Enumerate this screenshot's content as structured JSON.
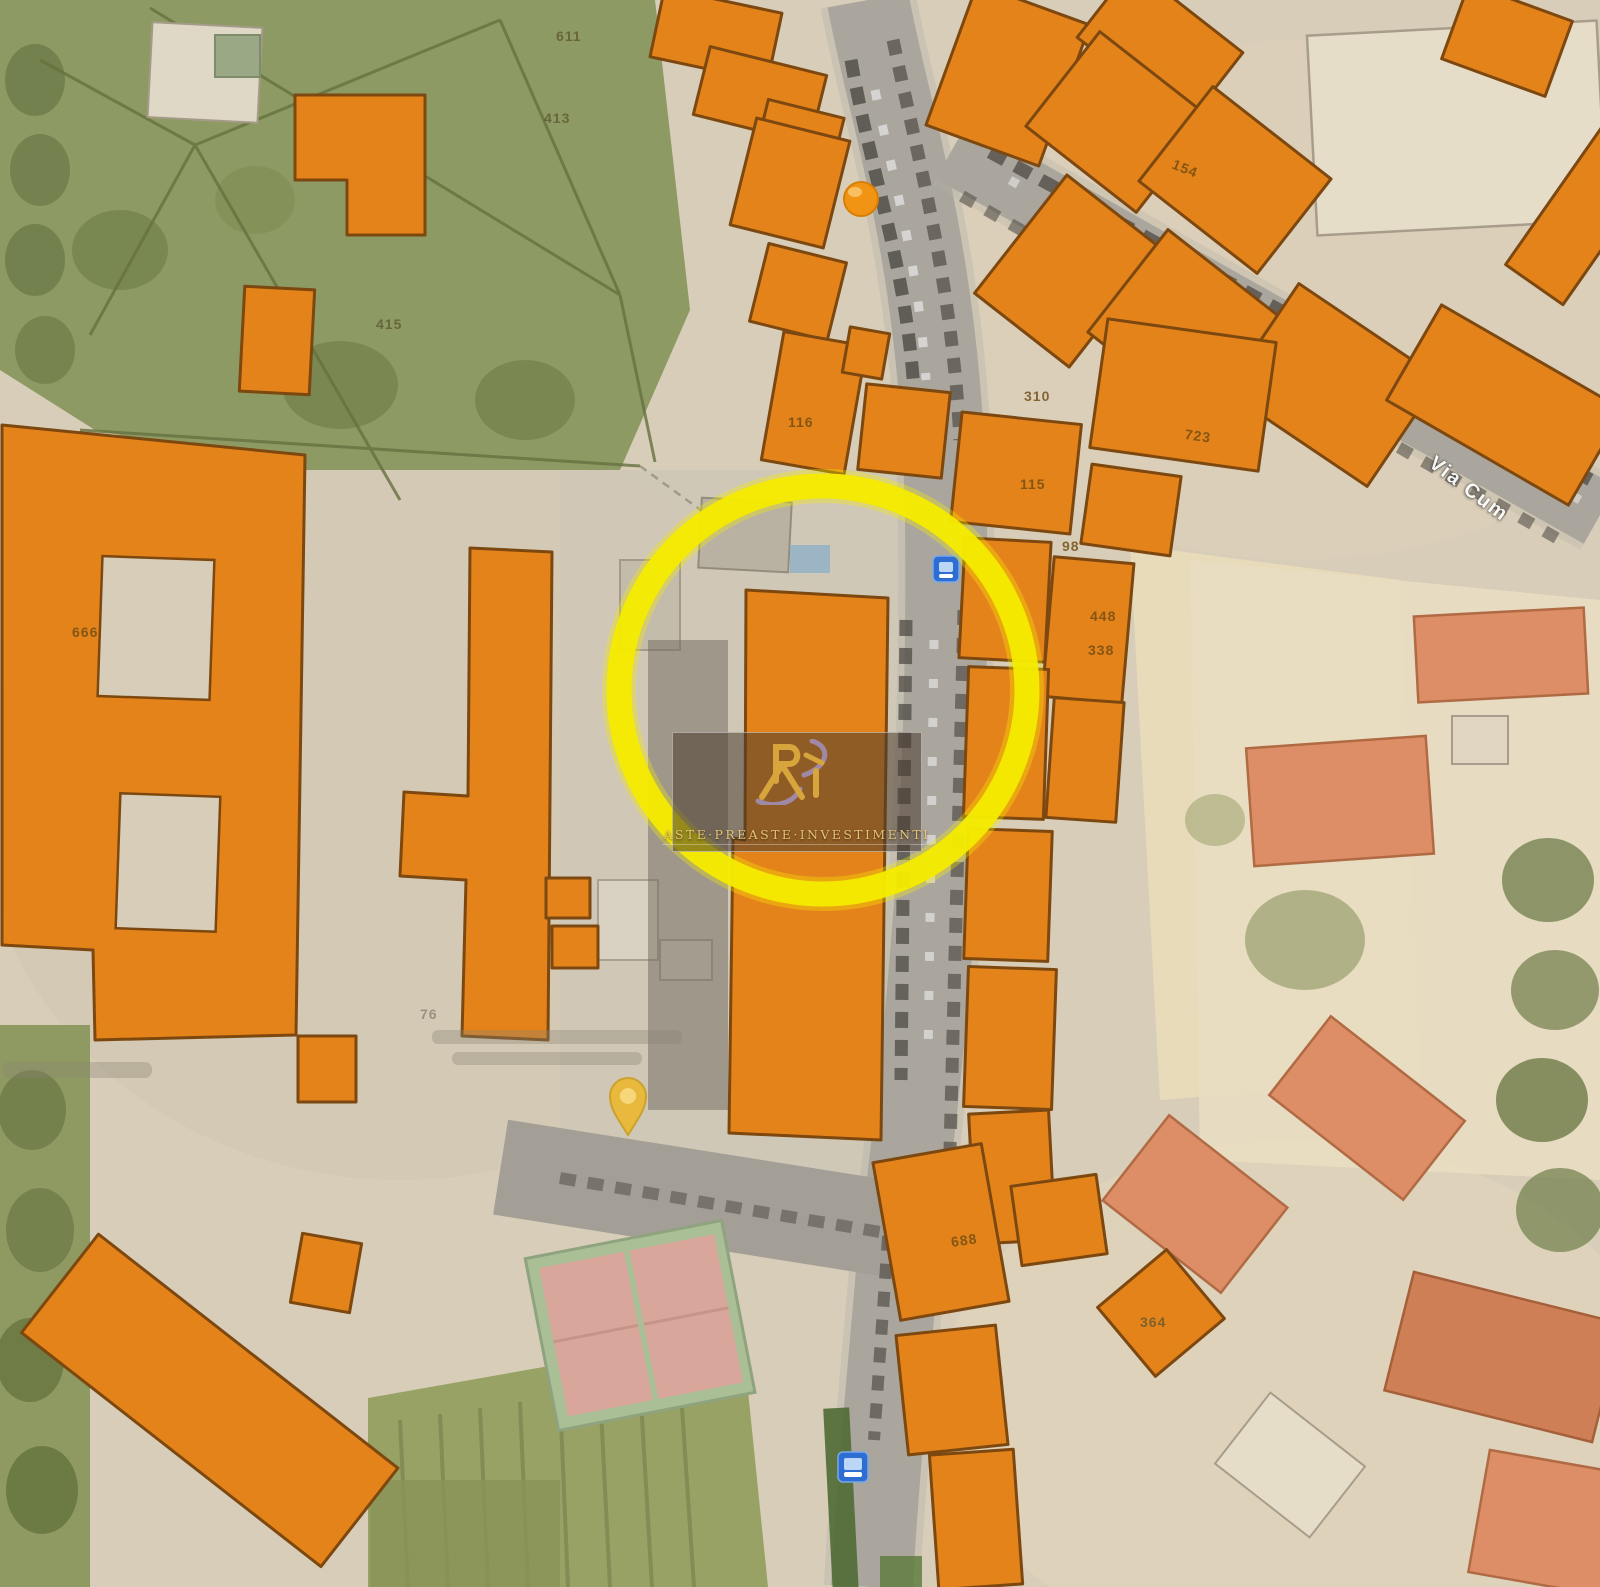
{
  "map": {
    "watermark": {
      "monogram": "Ri",
      "caption": "ASTE·PREASTE·INVESTIMENTI"
    },
    "street_labels": [
      {
        "text": "Via Cum",
        "x": 1438,
        "y": 452,
        "rot": 37
      }
    ],
    "parcel_labels": [
      {
        "text": "611",
        "x": 556,
        "y": 28,
        "rot": 0,
        "v": "green"
      },
      {
        "text": "413",
        "x": 544,
        "y": 110,
        "rot": 0,
        "v": "green"
      },
      {
        "text": "415",
        "x": 376,
        "y": 316,
        "rot": 0,
        "v": "green"
      },
      {
        "text": "666",
        "x": 72,
        "y": 624,
        "rot": 0,
        "v": "orange"
      },
      {
        "text": "116",
        "x": 788,
        "y": 414,
        "rot": 0,
        "v": "orange"
      },
      {
        "text": "154",
        "x": 1176,
        "y": 156,
        "rot": 22,
        "v": "orange"
      },
      {
        "text": "723",
        "x": 1186,
        "y": 426,
        "rot": 8,
        "v": "orange"
      },
      {
        "text": "310",
        "x": 1024,
        "y": 388,
        "rot": 0,
        "v": "orange"
      },
      {
        "text": "115",
        "x": 1020,
        "y": 476,
        "rot": 0,
        "v": "orange"
      },
      {
        "text": "98",
        "x": 1062,
        "y": 538,
        "rot": 0,
        "v": "orange"
      },
      {
        "text": "448",
        "x": 1090,
        "y": 608,
        "rot": 0,
        "v": "orange"
      },
      {
        "text": "338",
        "x": 1088,
        "y": 642,
        "rot": 0,
        "v": "orange"
      },
      {
        "text": "688",
        "x": 950,
        "y": 1234,
        "rot": -8,
        "v": "orange"
      },
      {
        "text": "364",
        "x": 1140,
        "y": 1314,
        "rot": 0,
        "v": "green"
      },
      {
        "text": "76",
        "x": 420,
        "y": 1006,
        "rot": 0,
        "v": "gray"
      }
    ],
    "highlight": {
      "cx": 823,
      "cy": 690,
      "r": 204,
      "stroke_width": 25,
      "color": "#f4eb00"
    },
    "icons": [
      {
        "name": "bus-stop-icon",
        "x": 933,
        "y": 556
      },
      {
        "name": "bus-stop-icon",
        "x": 838,
        "y": 1452
      },
      {
        "name": "map-pin-icon",
        "x": 628,
        "y": 1078
      },
      {
        "name": "poi-dot-icon",
        "x": 845,
        "y": 183
      }
    ],
    "colors": {
      "building_orange": "#e5831b",
      "building_outline": "#7c480f",
      "highlight_yellow": "#f4eb00",
      "road_gray": "#a7a29a",
      "park_green": "#8d9a63",
      "ground_tan": "#d8cdb8",
      "roof_red": "#dd8e66",
      "transit_blue": "#2e6ed2",
      "logo_gold": "#d7a53c"
    }
  }
}
